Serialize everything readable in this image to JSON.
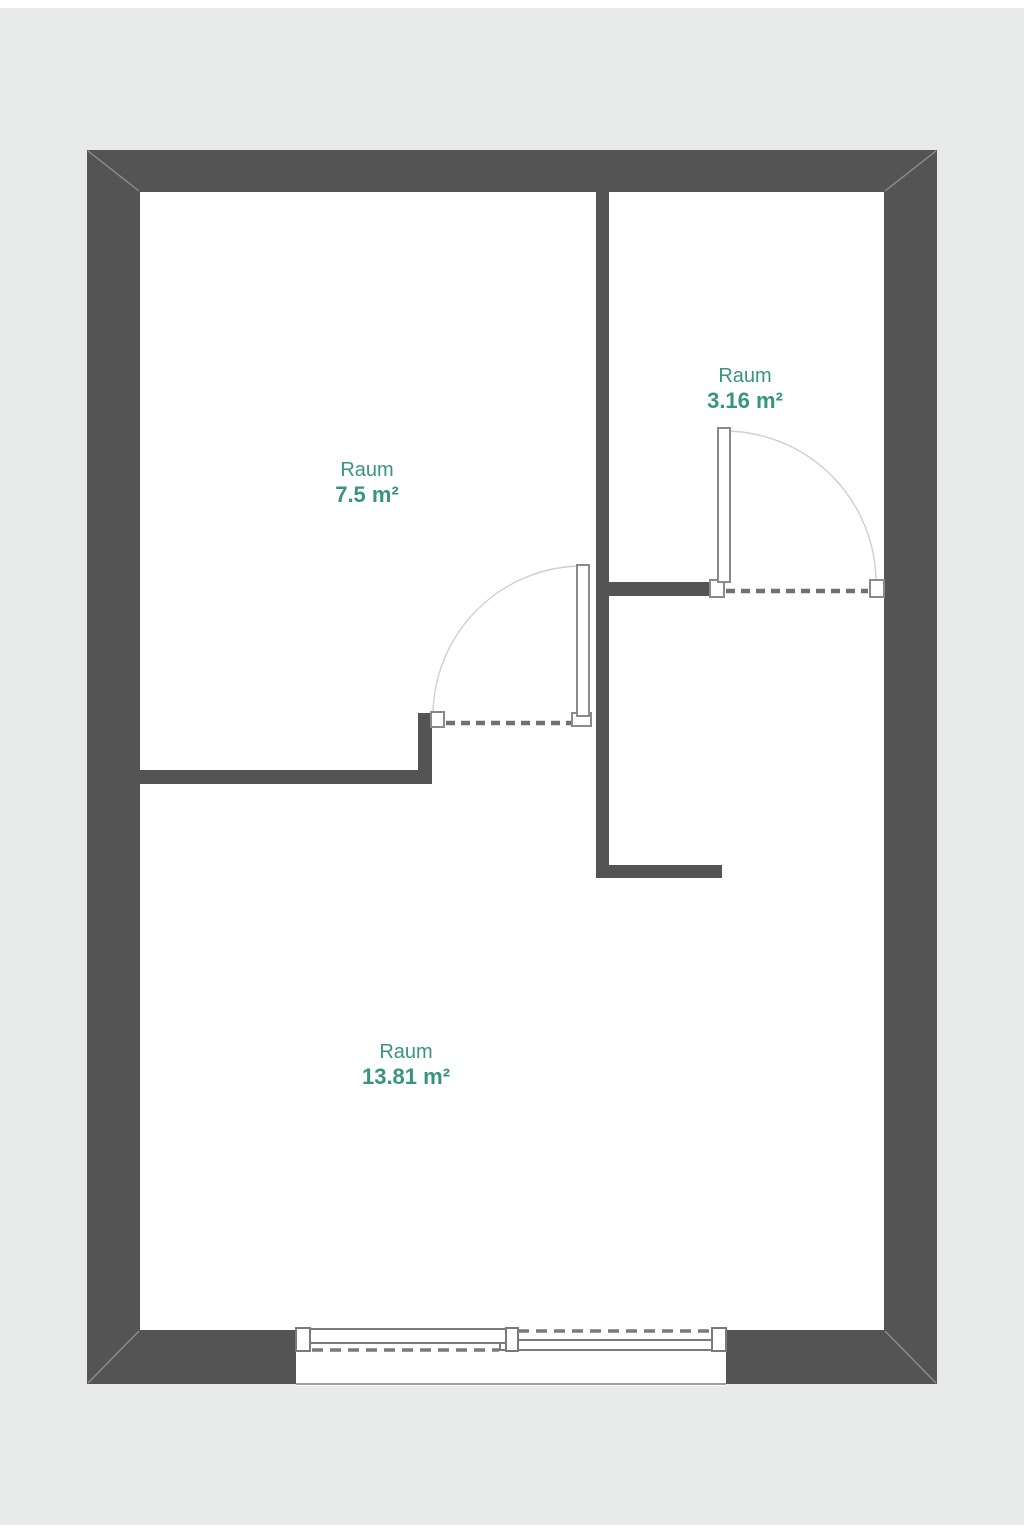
{
  "plan": {
    "type": "floorplan",
    "rooms": [
      {
        "name": "Raum",
        "area": "7.5 m²"
      },
      {
        "name": "Raum",
        "area": "3.16 m²"
      },
      {
        "name": "Raum",
        "area": "13.81 m²"
      }
    ],
    "features": {
      "doors": 2,
      "windows": 1,
      "door_symbols": "leaf with quarter-circle swing arc and dashed wall opening",
      "window_symbol": "double sliding panels with dashed tracks and sill"
    }
  },
  "colors": {
    "page_background": "#ffffff",
    "canvas_background": "#e8e9e9",
    "wall": "#545454",
    "floor": "#ffffff",
    "door_frame_outline": "#8a8a8a",
    "window_frame_outline": "#7a7a7a",
    "dashed_opening": "#707070",
    "swing_arc": "#cfcfcf",
    "sill_line": "#9e9e9e",
    "label_text": "#37957e"
  }
}
